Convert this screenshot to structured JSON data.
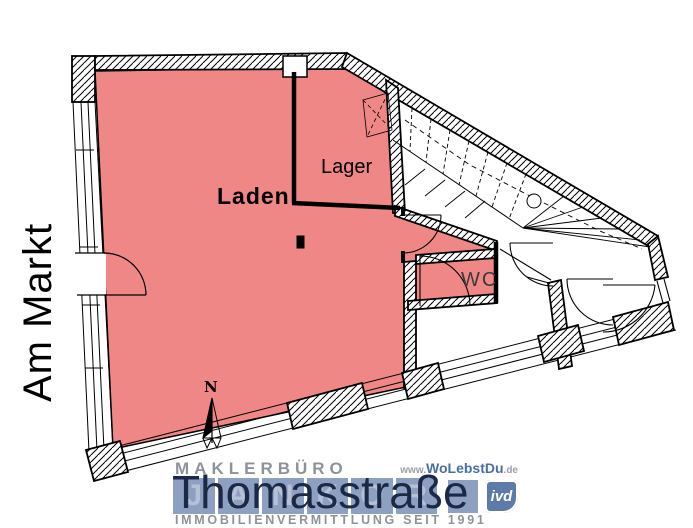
{
  "plan": {
    "room_labels": {
      "laden": "Laden",
      "lager": "Lager",
      "wc": "WC"
    },
    "street_left": "Am Markt",
    "street_bottom": "Thomasstraße",
    "north_label": "N",
    "colors": {
      "room_fill": "#ef8787",
      "line": "#000000",
      "wall_fill": "#ffffff"
    }
  },
  "watermark": {
    "line1": "MAKLERBÜRO",
    "brand": "JANKOR",
    "brand_letters": [
      "J",
      "A",
      "N",
      "K",
      "O",
      "R"
    ],
    "line2": "IMMOBILIENVERMITTLUNG SEIT 1991",
    "website_prefix": "www.",
    "website_name": "WoLebstDu",
    "website_suffix": ".de",
    "badge": "ivd",
    "colors": {
      "band": "#8da0c1",
      "band_letter": "#b6c1d6",
      "navy": "#1b2947",
      "blue": "#4a6fa5",
      "gray": "#8e939b",
      "badge_bg": "#5e7aa8"
    }
  }
}
